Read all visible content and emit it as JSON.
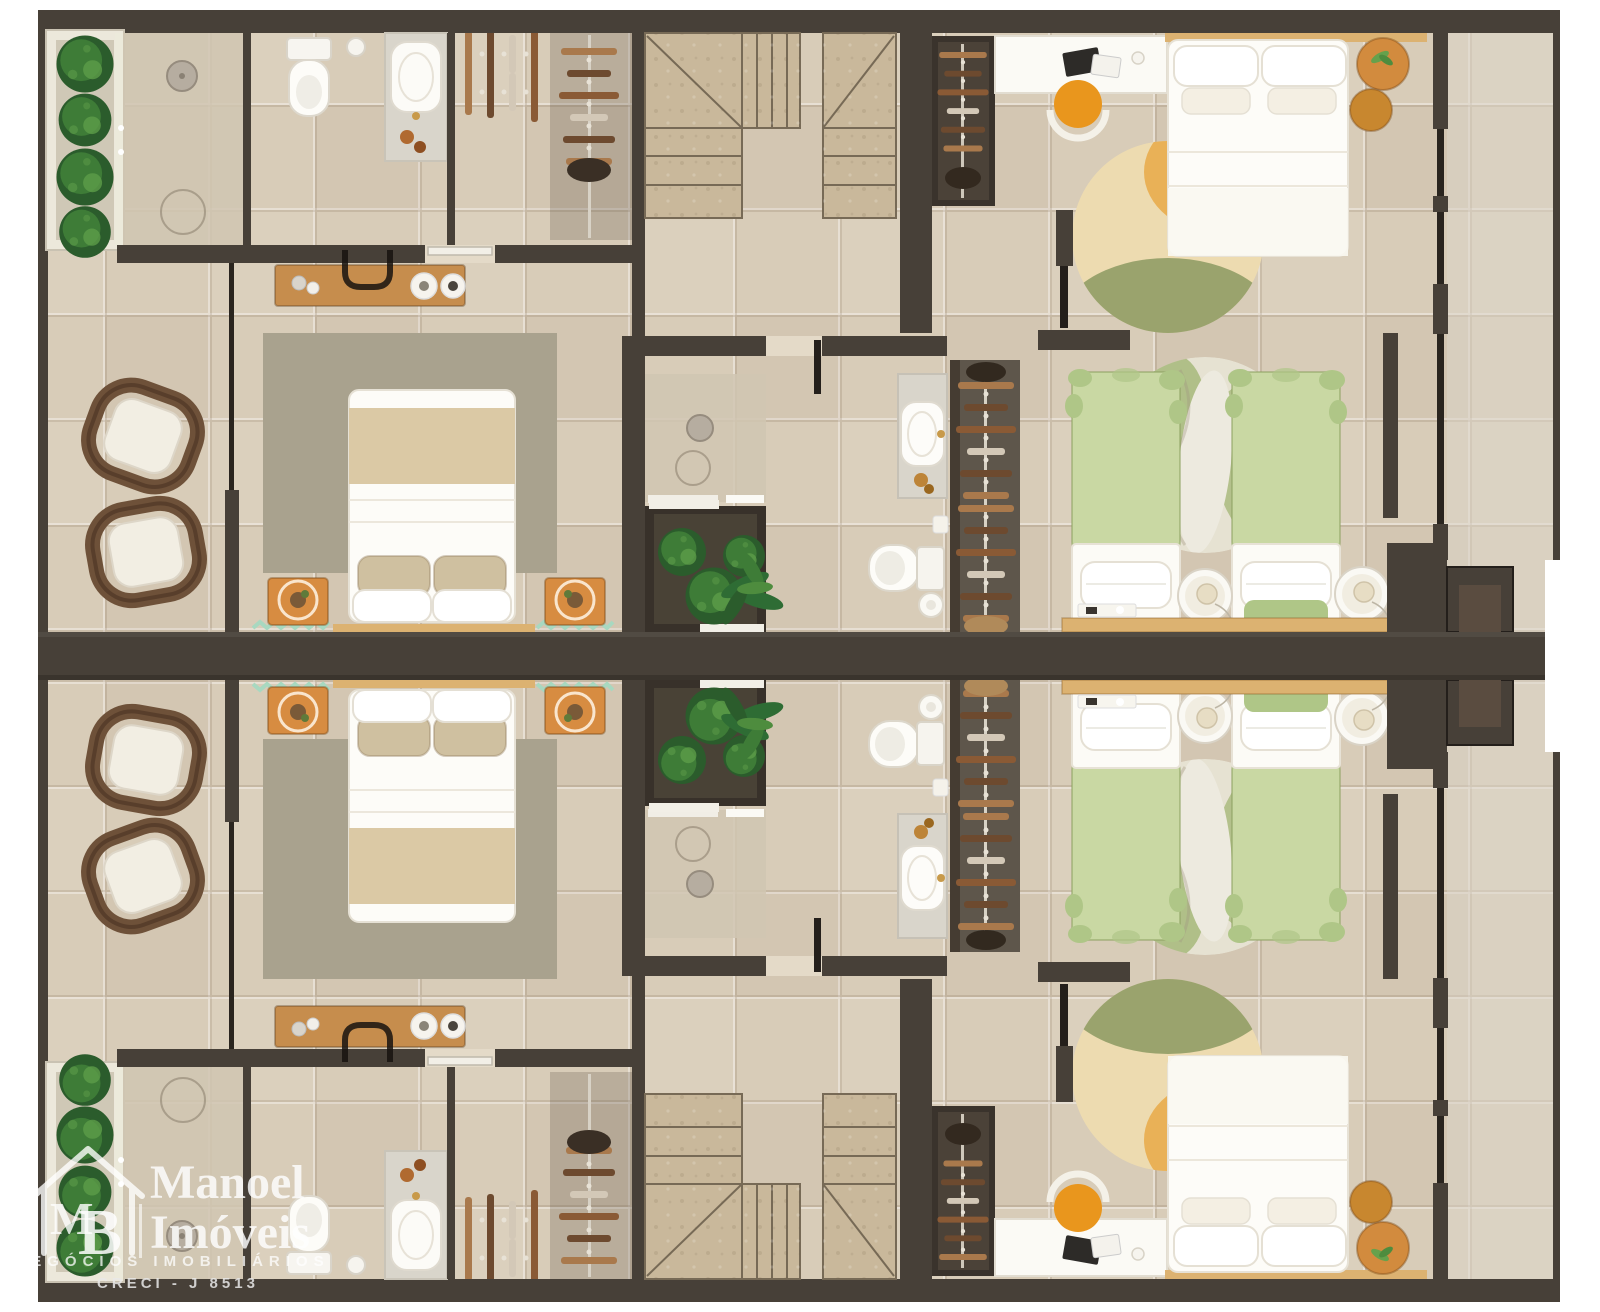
{
  "watermark": {
    "brand_line1": "Manoel",
    "brand_line2": "Imóveis",
    "monogram_m": "M",
    "monogram_b": "B",
    "tagline": "NEGÓCIOS IMOBILIÁRIOS",
    "license": "CRECI - J 8513"
  },
  "palette": {
    "wall": "#474038",
    "glassDark": "#2a251f",
    "floor": "#d8ccb8",
    "floorLight": "#e4dac8",
    "showerFloor": "#d0c5b1",
    "stair": "#c9b89b",
    "stairLine": "#776a56",
    "marble": "#d9d5cb",
    "bedBeige": "#dbc9a5",
    "pillowBeige": "#cfc0a0",
    "rugMaster": "#a9a28e",
    "rugTwinBase": "#e6e2d2",
    "rugTwinGreen": "#aabb80",
    "greenBed": "#c9d8a3",
    "greenBedDark": "#afc687",
    "wood": "#c68d4d",
    "woodShelf": "#dcb271",
    "orange": "#d78c41",
    "orangeDeep": "#e9961d",
    "pouf": "#d28b3e",
    "plantDark": "#2b5c2c",
    "plant": "#3e7c37",
    "plantLight": "#5d9c49",
    "wicker": "#6e5139",
    "cushion": "#f2eee3",
    "closetDark": "#3a332c",
    "closetMid": "#5e564b",
    "clothesA": "#a9794c",
    "clothesB": "#6d4a2f",
    "clothesC": "#d3c8b7",
    "clothesD": "#8a5a35",
    "gold": "#c89a4a",
    "rugCircleCream": "#eddbb0",
    "rugCircleOrange": "#e9b157",
    "rugCircleGreen": "#9aa36d",
    "zigzag": "#a8d8c0"
  }
}
